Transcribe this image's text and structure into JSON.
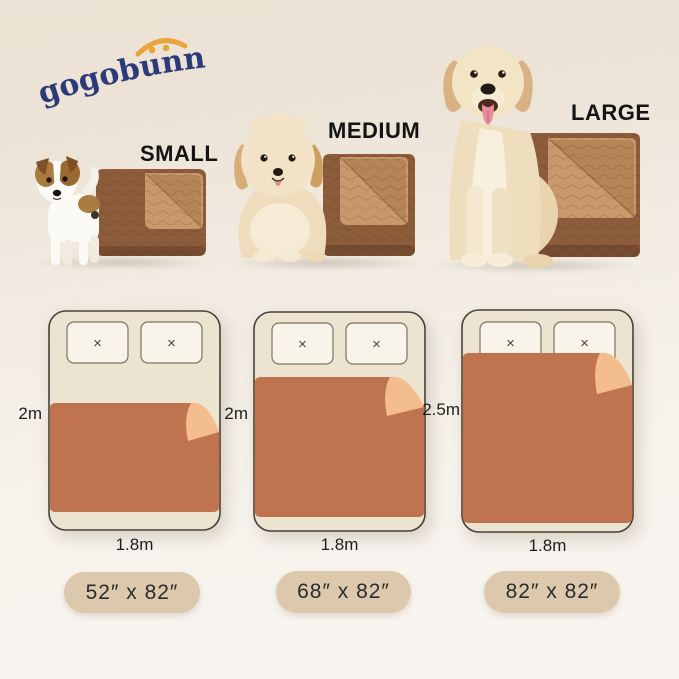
{
  "brand": {
    "name": "gogobunny",
    "text_color": "#2b3a78",
    "arc_color": "#e9a43c"
  },
  "icons": {
    "pillow_stitch": "×"
  },
  "products": [
    {
      "label": "SMALL",
      "dog": "jack-russell-puppy"
    },
    {
      "label": "MEDIUM",
      "dog": "fluffy-cream-puppy"
    },
    {
      "label": "LARGE",
      "dog": "golden-retriever"
    }
  ],
  "product_colors": {
    "blanket_top": "#8c5c3b",
    "blanket_fold": "#c9996c"
  },
  "bed_diagrams": [
    {
      "bed_length_label": "2m",
      "bed_width_label": "1.8m",
      "blanket_size_label": "52″ x 82″"
    },
    {
      "bed_length_label": "2m",
      "bed_width_label": "1.8m",
      "blanket_size_label": "68″ x 82″"
    },
    {
      "bed_length_label": "2.5m",
      "bed_width_label": "1.8m",
      "blanket_size_label": "82″ x 82″"
    }
  ],
  "diagram_colors": {
    "blanket": "#c0734f",
    "fold": "#f3bd8d",
    "bed": "#ece3d1",
    "pillow": "#f8f4e9",
    "badge_bg": "#dcc9ad"
  }
}
